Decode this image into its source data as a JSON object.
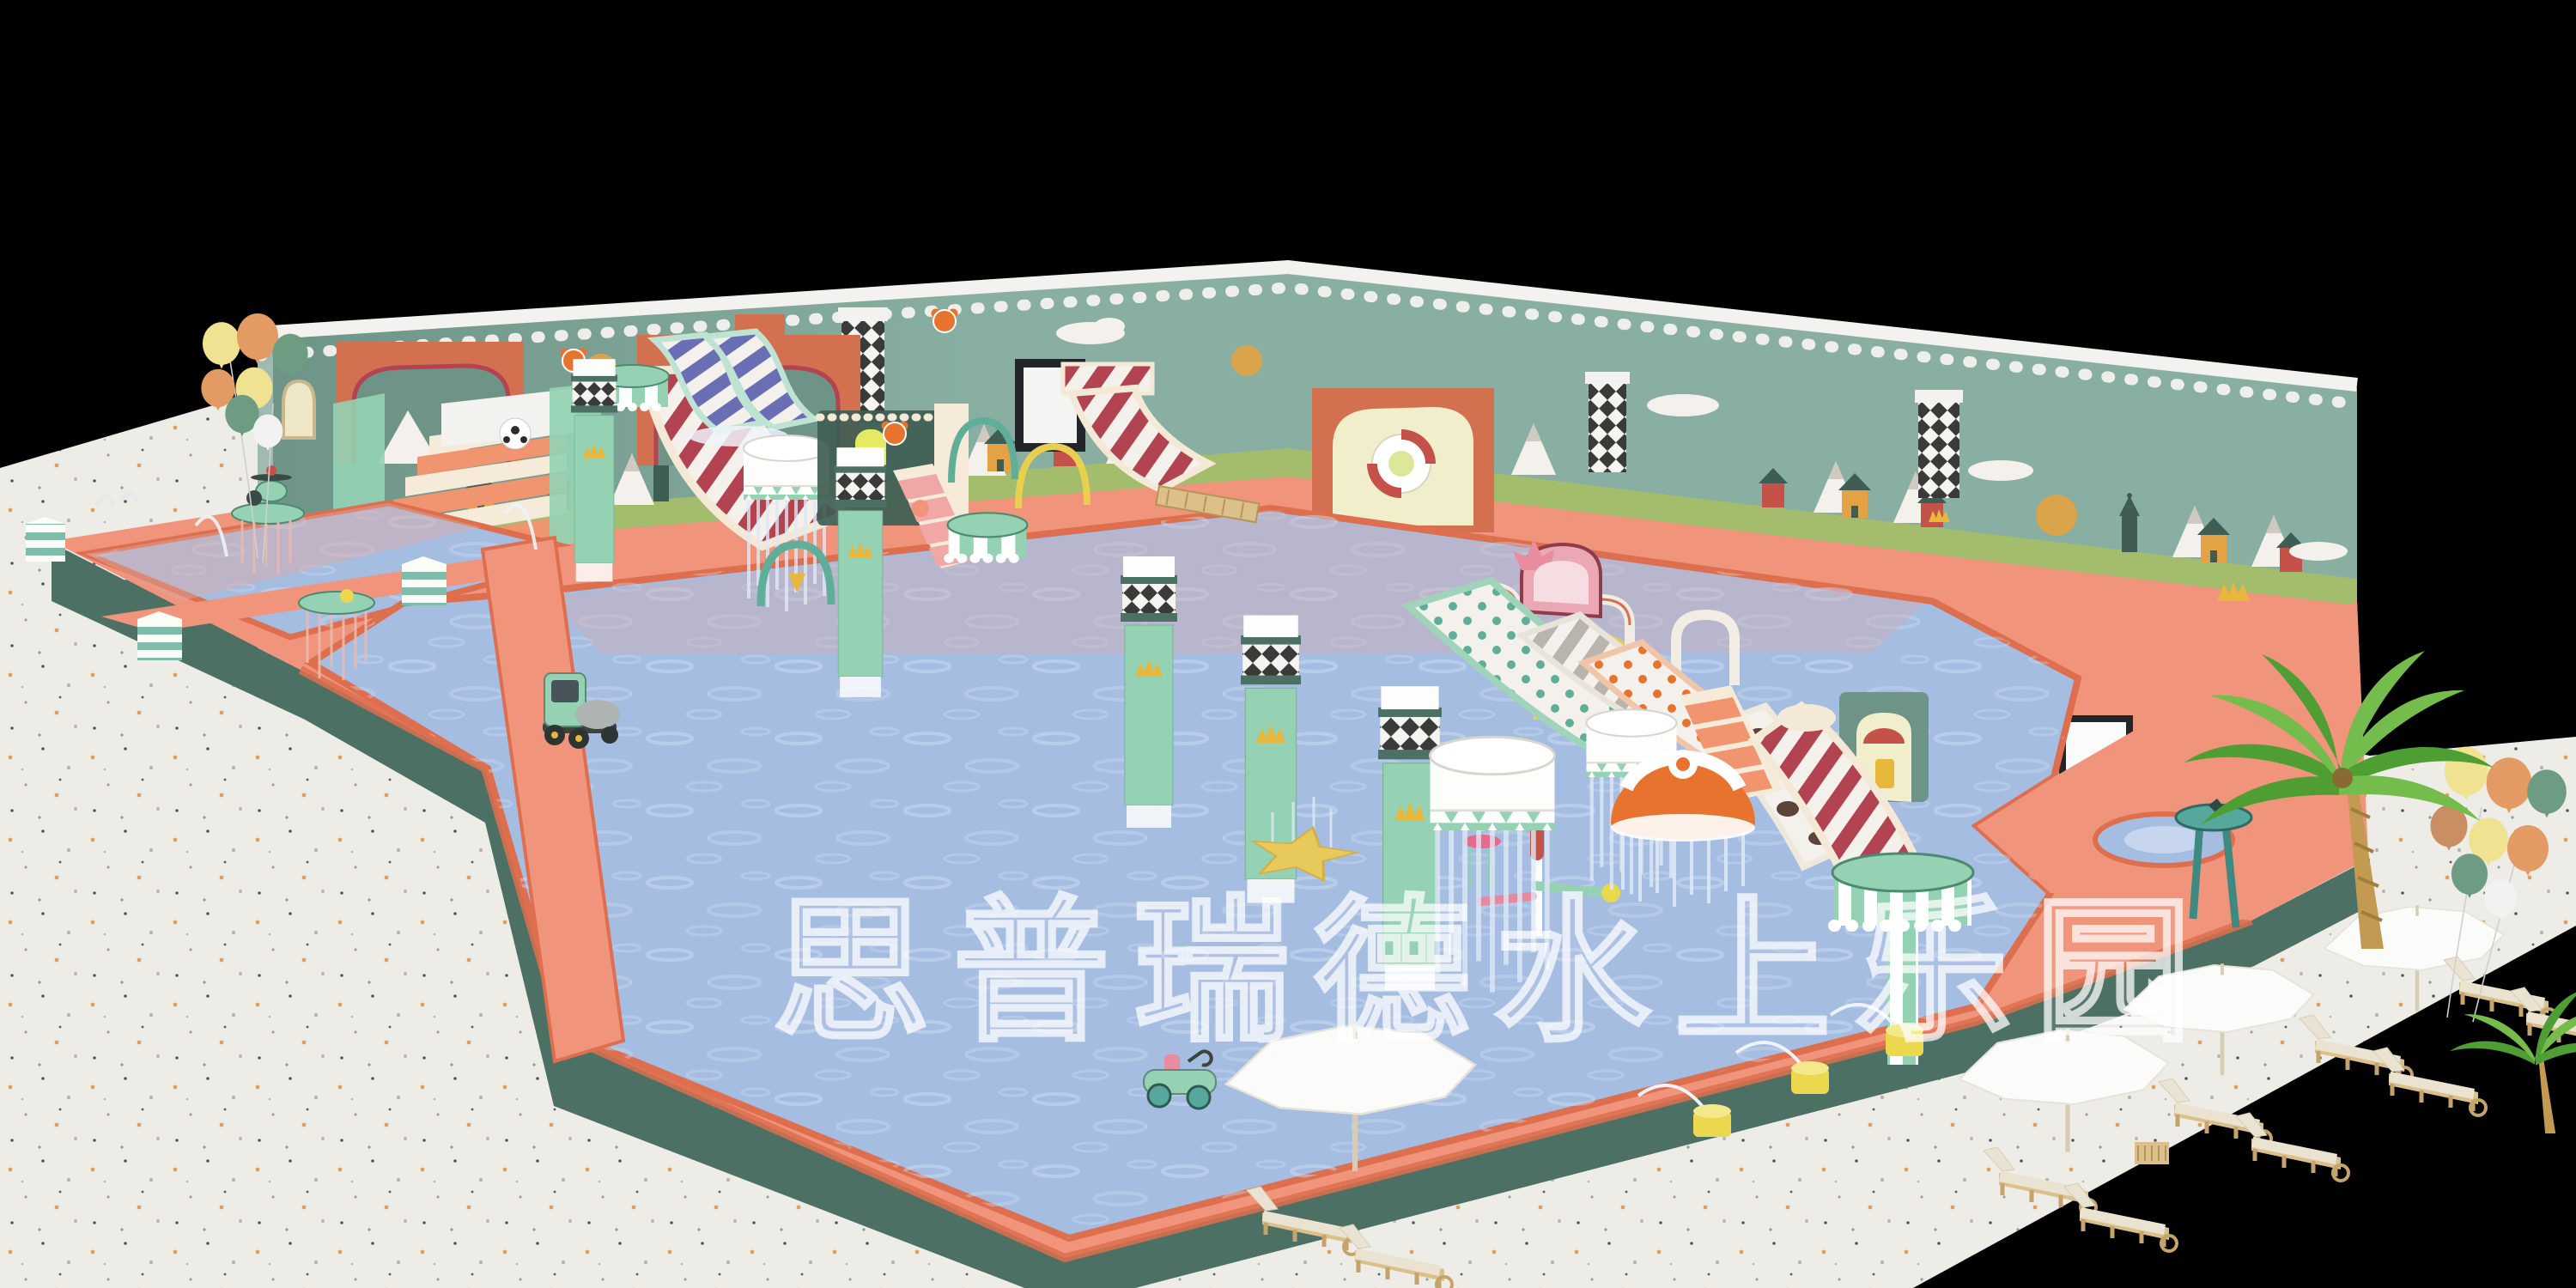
{
  "scene": {
    "description": "3D concept render of an indoor children's water playground (kids water park) viewed in perspective on a black backdrop",
    "watermark": "思普瑞德水上乐园",
    "welcome_sign": "WELCOME"
  },
  "colors": {
    "bg": "#000000",
    "floor": "#edebe5",
    "speckleOrange": "#dd9a58",
    "speckleDark": "#50505a",
    "speckleGray": "#b7b1a6",
    "speckleTeal": "#87a396",
    "deck": "#f0947c",
    "deckDark": "#dd6f4e",
    "poolBase": "#4d7064",
    "water": "#a6bde2",
    "waterLight": "#cfdcf1",
    "waterPink": "#dba8a4",
    "wall": "#88afa2",
    "wallDark": "#6e9488",
    "trim": "#f3f2ee",
    "grass": "#a3bd6d",
    "archOrange": "#d2704f",
    "muralOrange": "#e3a344",
    "muralRed": "#c55248",
    "muralDark": "#3f5d54",
    "muralWhite": "#f4f1ec",
    "cream": "#f6ead8",
    "slideRed": "#b24350",
    "slideBlue": "#6a6fb5",
    "slidePink": "#f2a7a7",
    "stairCoral": "#f0956f",
    "mint": "#94d2b3",
    "mintDark": "#5fae99",
    "gold": "#e8b83d",
    "targetOrange": "#e8732e",
    "starYellow": "#e8c95c",
    "jetYellow": "#ecd84f",
    "balloonYellow": "#efe291",
    "balloonOrange": "#e49a63",
    "balloonGreen": "#6e9c82",
    "balloonWhite": "#f2f2f2",
    "palm": "#4f9e33",
    "palmLight": "#74bc4b",
    "trunk": "#c29a52",
    "wood": "#dcc08c",
    "woodDark": "#c6a469",
    "cushion": "#eae3d2",
    "umbrella": "#fbfbf9",
    "checkerDark": "#3a3a3a",
    "cowBrown": "#5d4439"
  }
}
